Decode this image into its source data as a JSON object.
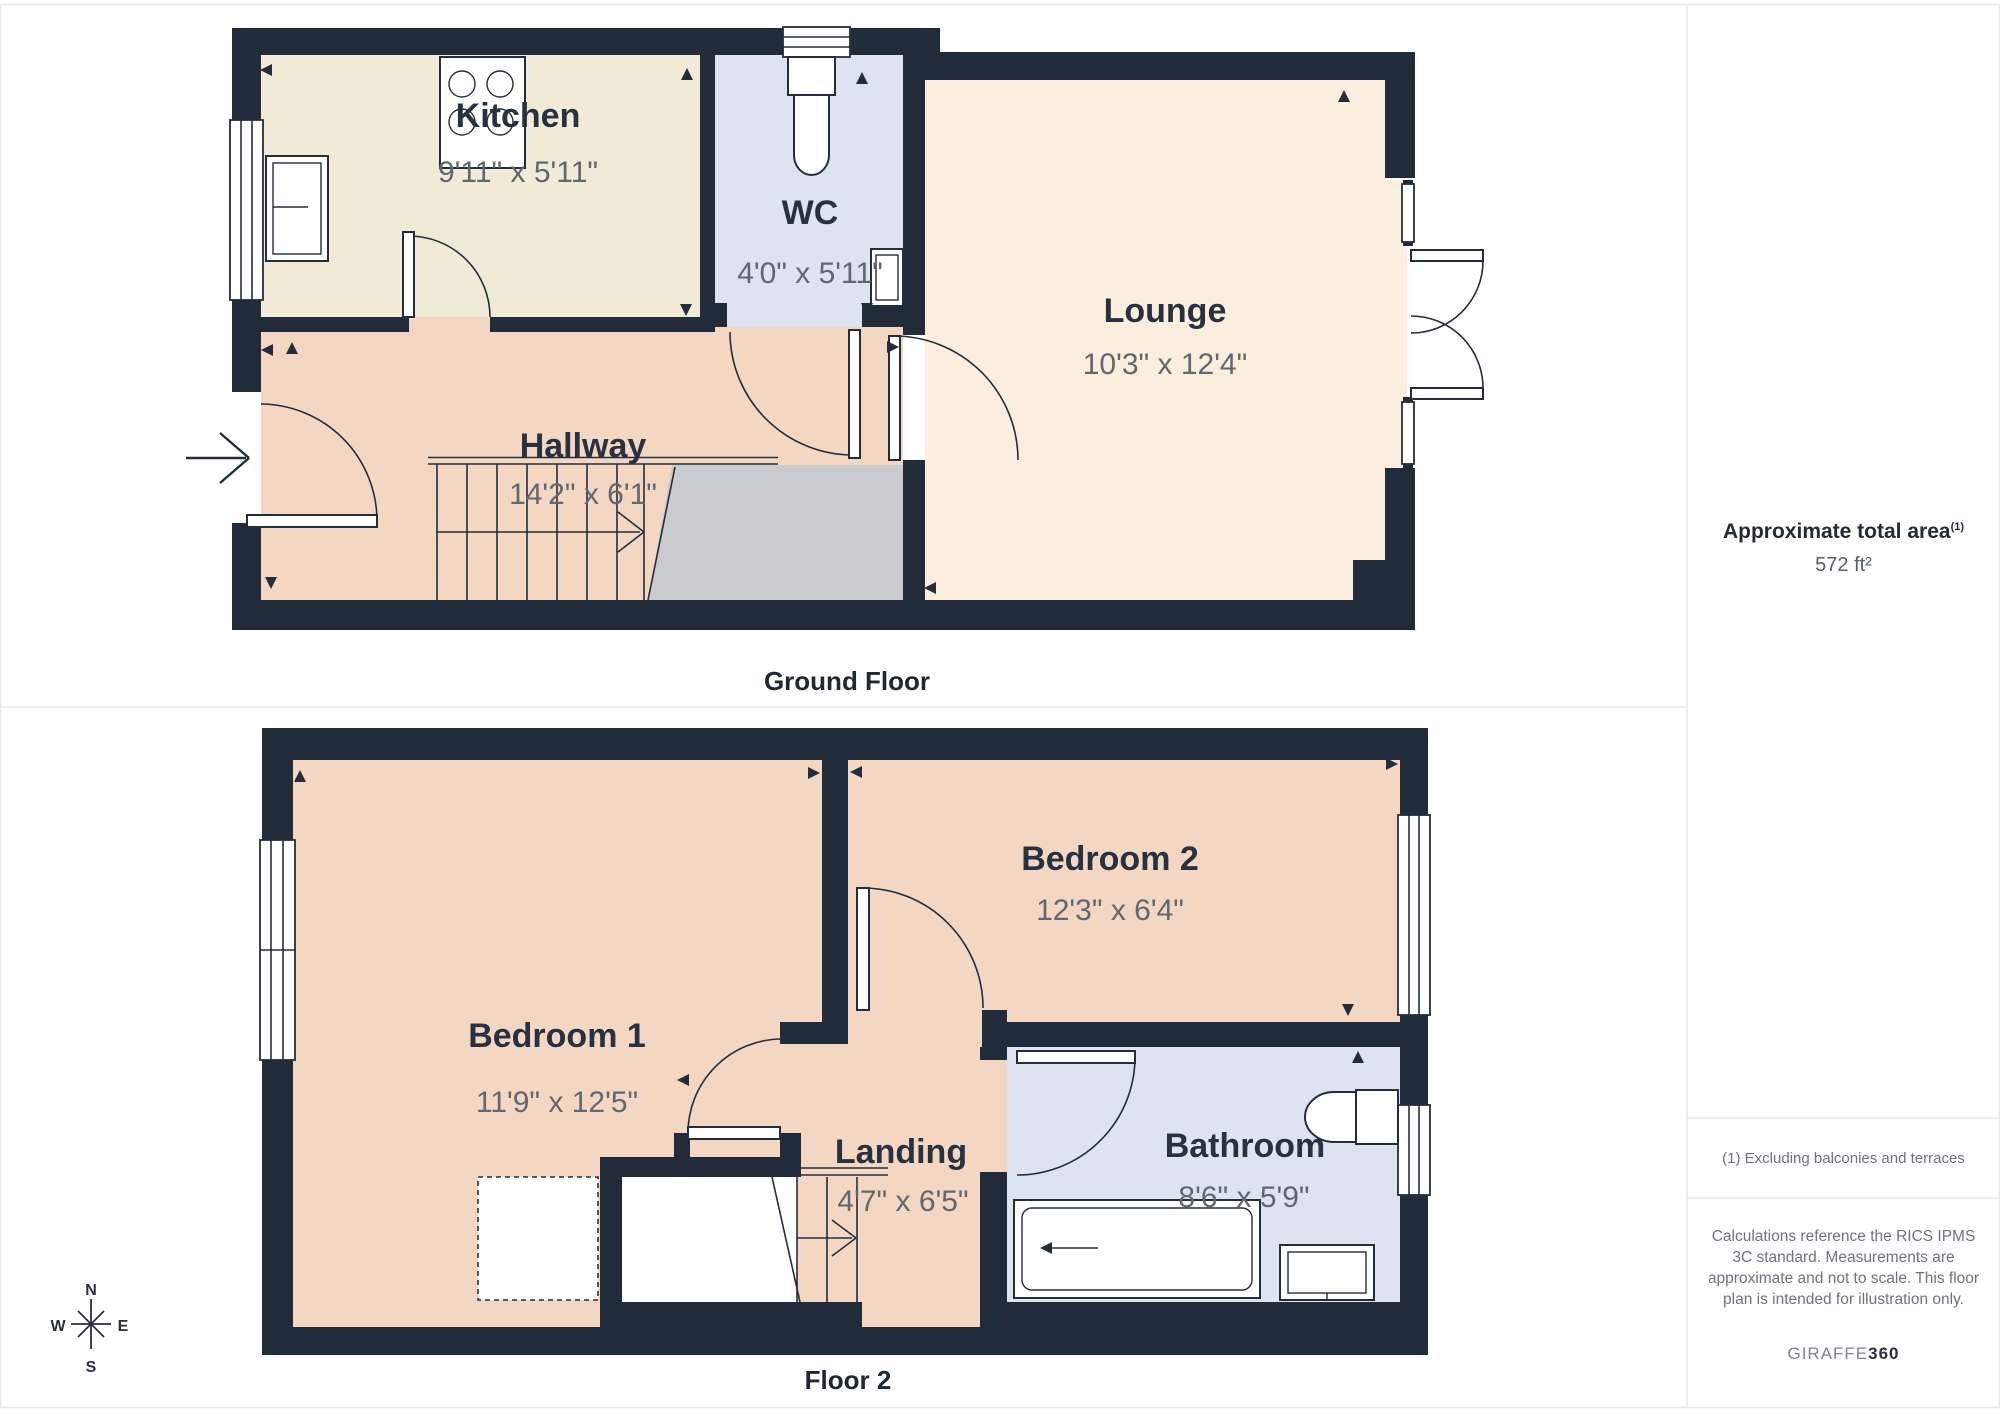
{
  "colors": {
    "wall": "#212b3a",
    "kitchen": "#f0ead6",
    "wc": "#dde3f1",
    "lounge": "#fceede",
    "hall": "#f4d7c3",
    "gray": "#c9cbce"
  },
  "floors": [
    {
      "caption": "Ground Floor",
      "rooms": [
        {
          "name": "Kitchen",
          "dims": "9'11\" x 5'11\""
        },
        {
          "name": "WC",
          "dims": "4'0\" x 5'11\""
        },
        {
          "name": "Lounge",
          "dims": "10'3\" x 12'4\""
        },
        {
          "name": "Hallway",
          "dims": "14'2\" x 6'1\""
        }
      ]
    },
    {
      "caption": "Floor 2",
      "rooms": [
        {
          "name": "Bedroom 1",
          "dims": "11'9\" x 12'5\""
        },
        {
          "name": "Bedroom 2",
          "dims": "12'3\" x 6'4\""
        },
        {
          "name": "Landing",
          "dims": "4'7\" x 6'5\""
        },
        {
          "name": "Bathroom",
          "dims": "8'6\" x 5'9\""
        }
      ]
    }
  ],
  "compass": {
    "north": "N",
    "east": "E",
    "south": "S",
    "west": "W"
  },
  "sidebar": {
    "area_title": "Approximate total area",
    "area_title_sup": "(1)",
    "area_value": "572 ft²",
    "note": "(1) Excluding balconies and terraces",
    "disclaimer": "Calculations reference the RICS IPMS 3C standard. Measurements are approximate and not to scale. This floor plan is intended for illustration only.",
    "brand_name": "GIRAFFE",
    "brand_suffix": "360"
  }
}
